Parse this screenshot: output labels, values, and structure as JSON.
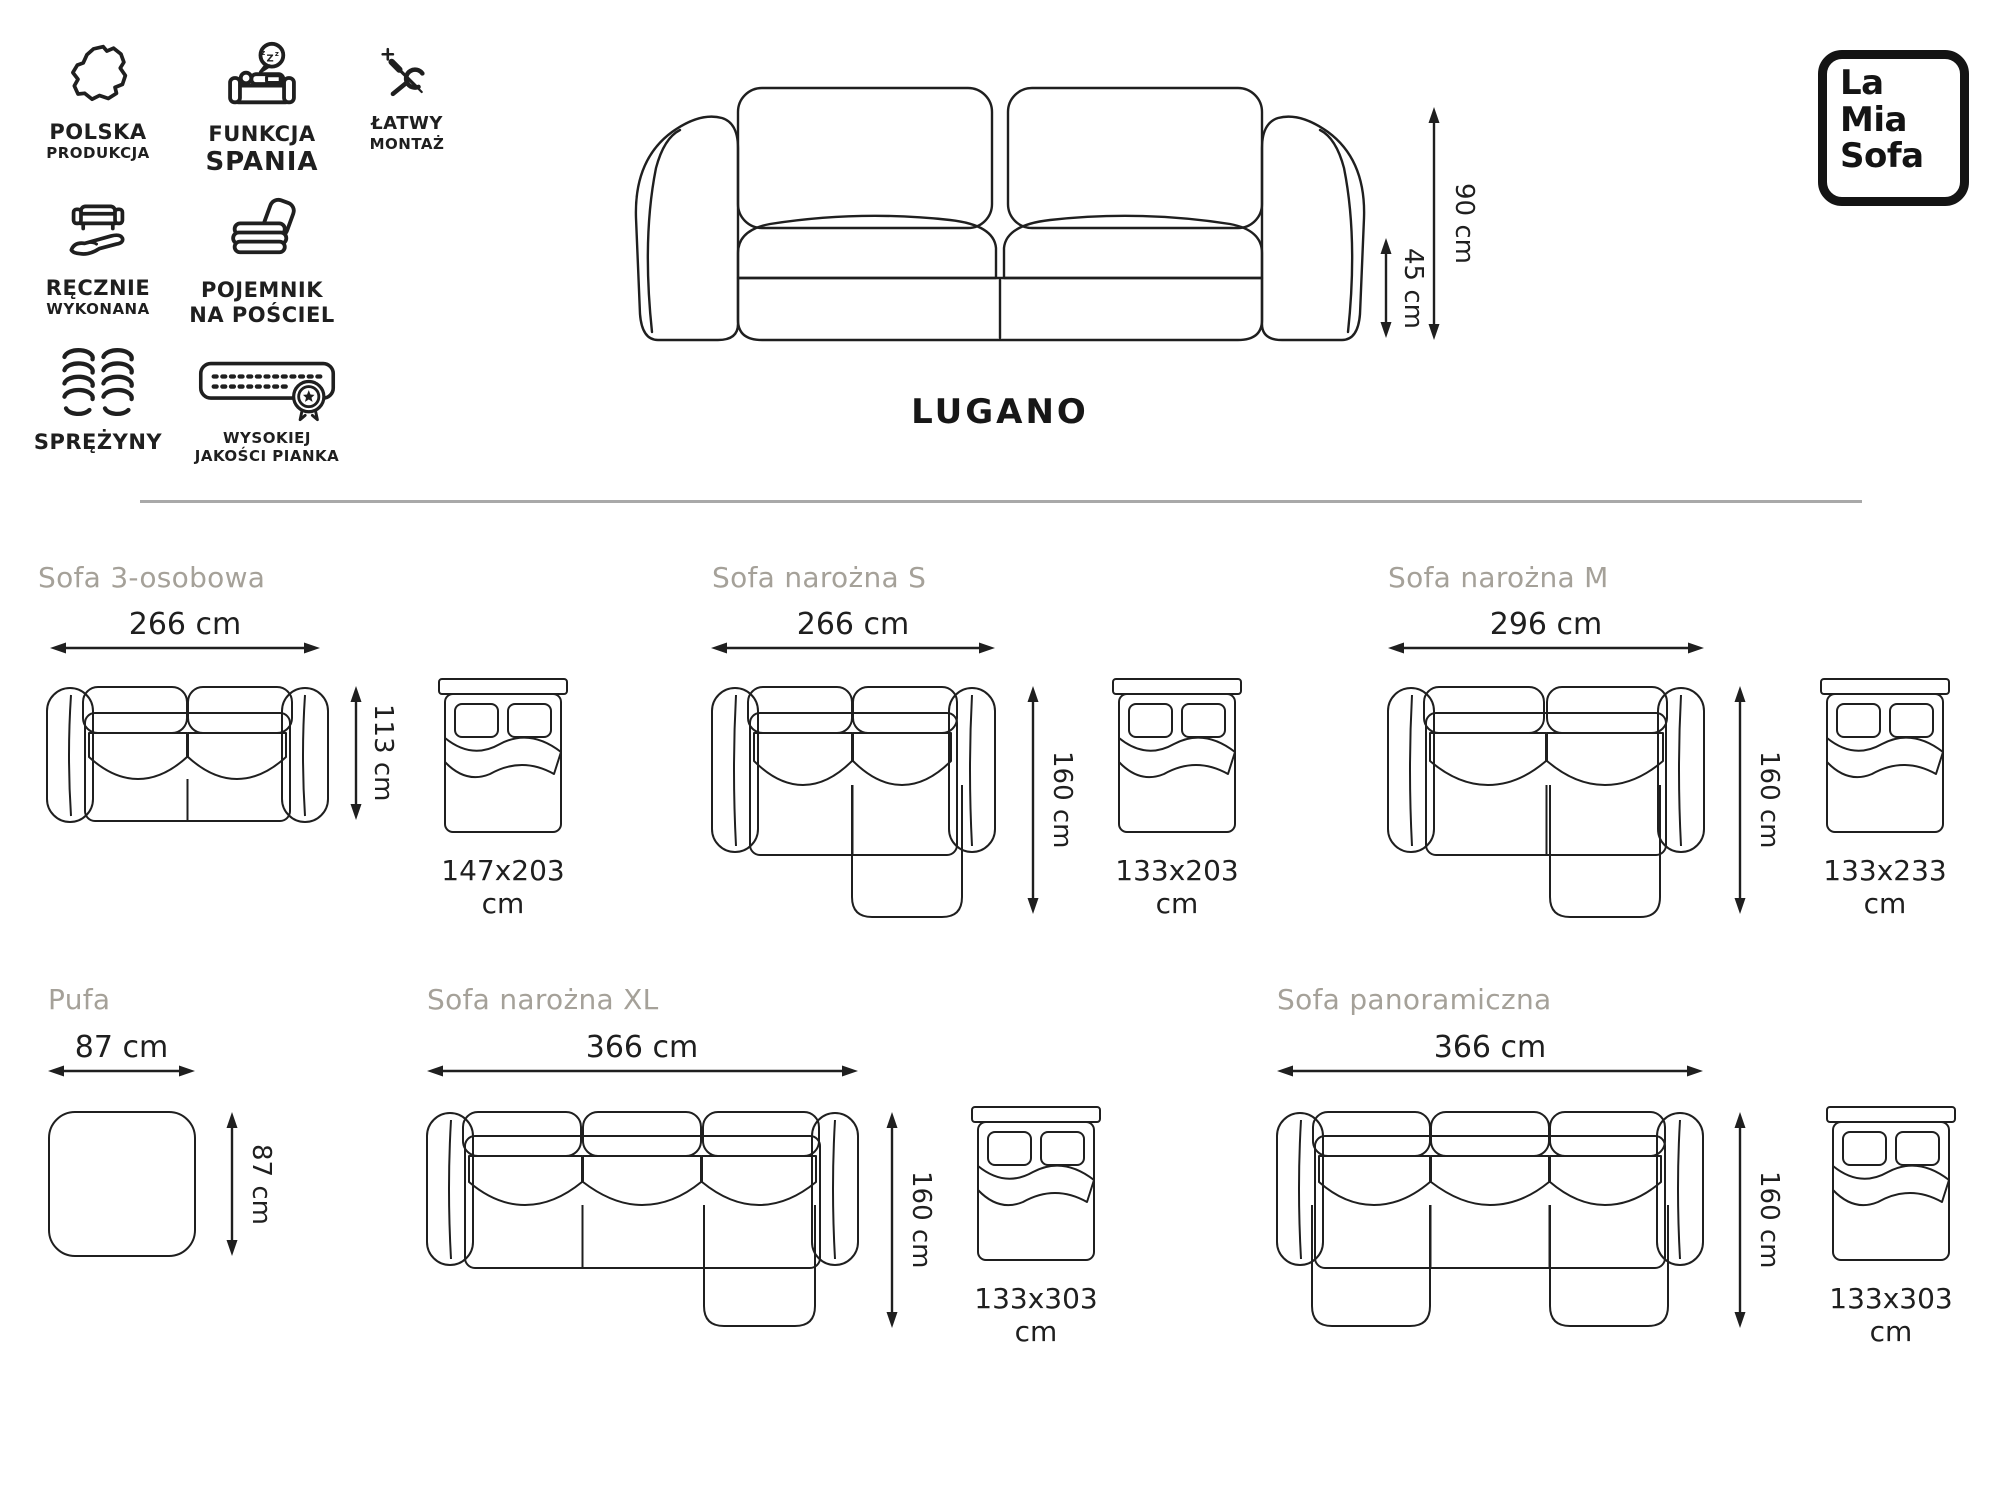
{
  "header": {
    "badges": [
      {
        "icon": "poland-map-icon",
        "line1": "POLSKA",
        "line2": "PRODUKCJA"
      },
      {
        "icon": "sleep-function-icon",
        "line1": "FUNKCJA",
        "line2": "SPANIA"
      },
      {
        "icon": "tools-icon",
        "line1": "ŁATWY",
        "line2": "MONTAŻ"
      },
      {
        "icon": "handmade-icon",
        "line1": "RĘCZNIE",
        "line2": "WYKONANA"
      },
      {
        "icon": "bedding-container-icon",
        "line1": "POJEMNIK",
        "line2": "NA POŚCIEL"
      },
      {
        "icon": "springs-icon",
        "line1": "SPRĘŻYNY",
        "line2": ""
      },
      {
        "icon": "foam-quality-icon",
        "line1": "WYSOKIEJ",
        "line2": "JAKOŚCI PIANKA"
      }
    ],
    "logo": {
      "line1": "La",
      "line2": "Mia",
      "line3": "Sofa"
    },
    "hero": {
      "name": "LUGANO",
      "height_label": "90 cm",
      "seat_height_label": "45 cm"
    }
  },
  "variants": [
    {
      "title": "Sofa 3-osobowa",
      "width_label": "266 cm",
      "depth_label": "113 cm",
      "bed_label": "147x203 cm"
    },
    {
      "title": "Sofa narożna S",
      "width_label": "266 cm",
      "depth_label": "160 cm",
      "bed_label": "133x203 cm"
    },
    {
      "title": "Sofa narożna M",
      "width_label": "296 cm",
      "depth_label": "160 cm",
      "bed_label": "133x233 cm"
    },
    {
      "title": "Pufa",
      "width_label": "87 cm",
      "depth_label": "87 cm",
      "bed_label": ""
    },
    {
      "title": "Sofa narożna XL",
      "width_label": "366 cm",
      "depth_label": "160 cm",
      "bed_label": "133x303 cm"
    },
    {
      "title": "Sofa panoramiczna",
      "width_label": "366 cm",
      "depth_label": "160 cm",
      "bed_label": "133x303 cm"
    }
  ],
  "colors": {
    "line": "#1f1f1f",
    "heading": "#a5a199",
    "divider": "#a9a9a9",
    "background": "#ffffff"
  }
}
